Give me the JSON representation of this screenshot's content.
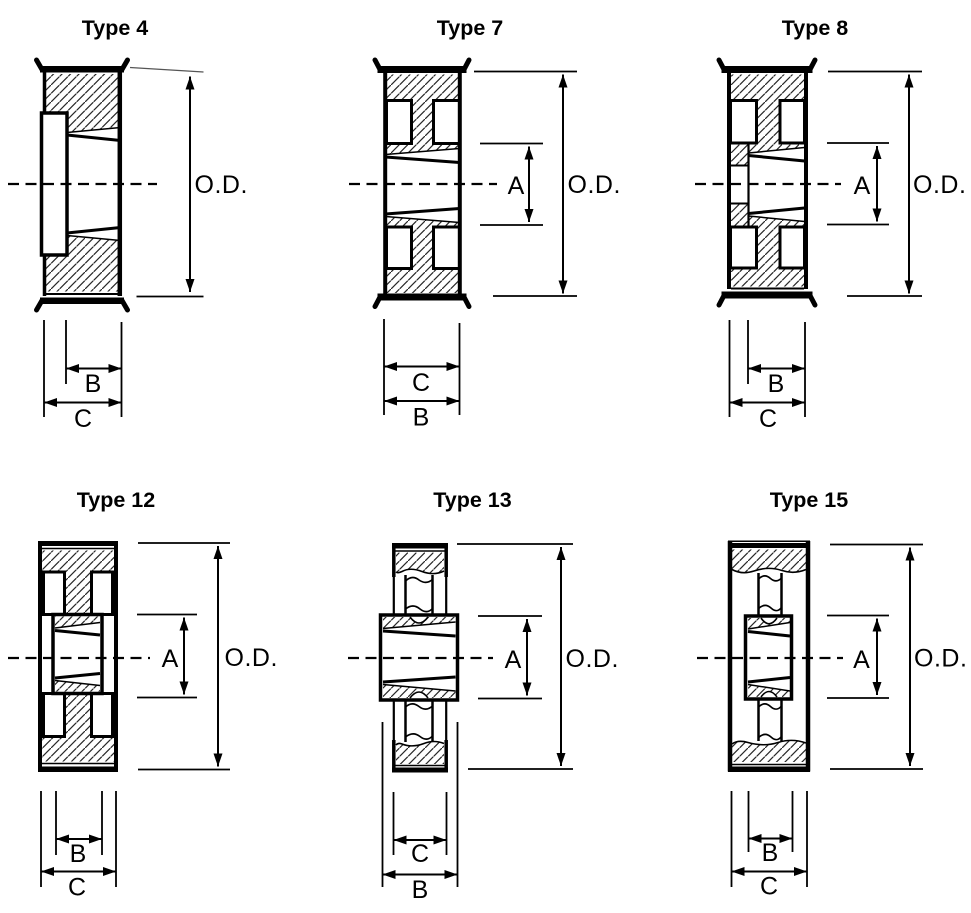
{
  "page": {
    "background": "#ffffff",
    "ink": "#000000"
  },
  "figures": [
    {
      "id": "type-4",
      "title": "Type 4",
      "labels": {
        "od": "O.D.",
        "b": "B",
        "c": "C"
      }
    },
    {
      "id": "type-7",
      "title": "Type 7",
      "labels": {
        "od": "O.D.",
        "a": "A",
        "c": "C",
        "b": "B"
      }
    },
    {
      "id": "type-8",
      "title": "Type 8",
      "labels": {
        "od": "O.D.",
        "a": "A",
        "b": "B",
        "c": "C"
      }
    },
    {
      "id": "type-12",
      "title": "Type 12",
      "labels": {
        "od": "O.D.",
        "a": "A",
        "b": "B",
        "c": "C"
      }
    },
    {
      "id": "type-13",
      "title": "Type 13",
      "labels": {
        "od": "O.D.",
        "a": "A",
        "c": "C",
        "b": "B"
      }
    },
    {
      "id": "type-15",
      "title": "Type 15",
      "labels": {
        "od": "O.D.",
        "a": "A",
        "b": "B",
        "c": "C"
      }
    }
  ]
}
